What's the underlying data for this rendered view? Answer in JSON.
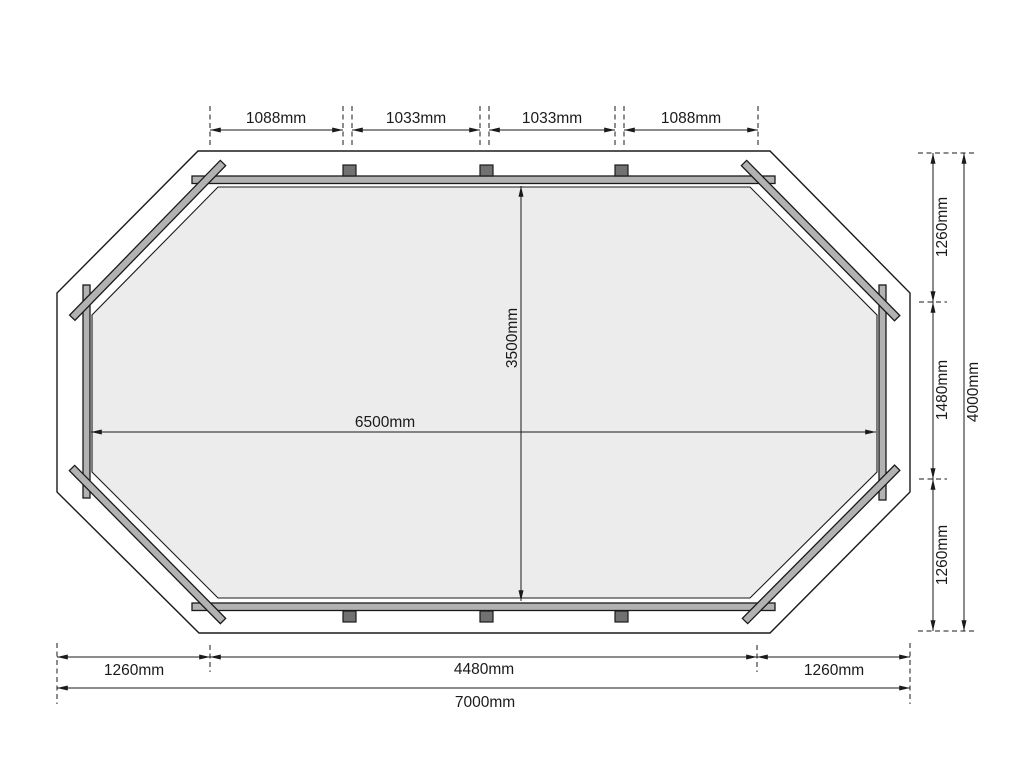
{
  "drawing": {
    "kind": "octagonal floor plan dimension drawing",
    "unit": "mm"
  },
  "dimensions": {
    "top": [
      "1088mm",
      "1033mm",
      "1033mm",
      "1088mm"
    ],
    "right": [
      "1260mm",
      "1480mm",
      "1260mm"
    ],
    "right_total": "4000mm",
    "bottom": [
      "1260mm",
      "4480mm",
      "1260mm"
    ],
    "bottom_total": "7000mm",
    "floor_width": "6500mm",
    "floor_height": "3500mm"
  },
  "colors": {
    "background": "#ffffff",
    "line": "#1a1a1a",
    "floor_fill": "#ececec",
    "plank_fill": "#b2b2b2",
    "post_fill": "#717171"
  }
}
